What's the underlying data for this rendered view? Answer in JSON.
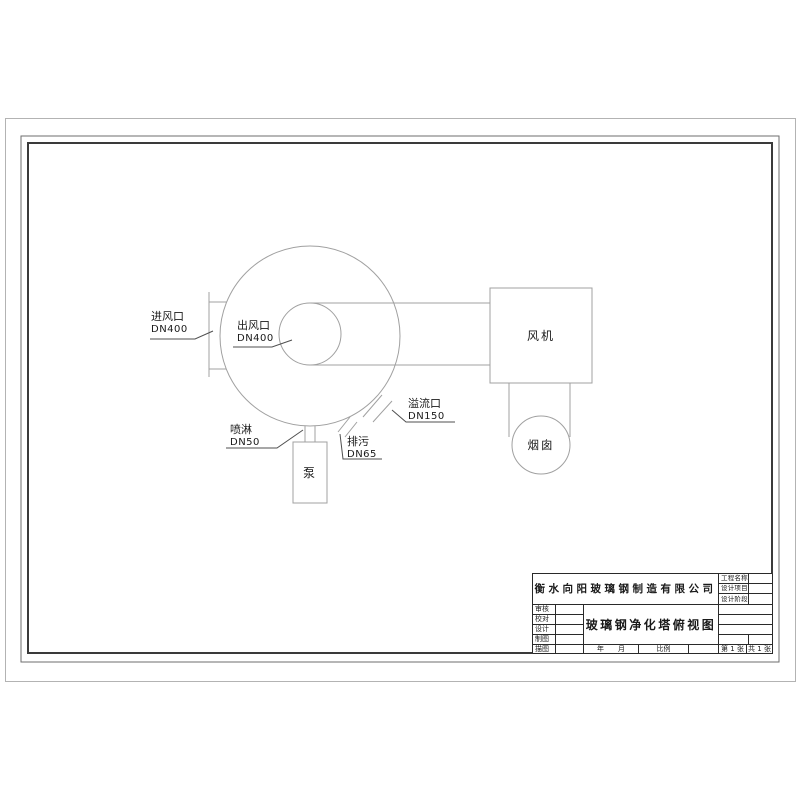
{
  "schematic": {
    "tower_inlet": {
      "name": "进风口",
      "size": "DN400"
    },
    "tower_outlet": {
      "name": "出风口",
      "size": "DN400"
    },
    "spray": {
      "name": "喷淋",
      "size": "DN50"
    },
    "drain": {
      "name": "排污",
      "size": "DN65"
    },
    "overflow": {
      "name": "溢流口",
      "size": "DN150"
    },
    "pump_label": "泵",
    "fan_label": "风机",
    "chimney_label": "烟囱"
  },
  "title_block": {
    "company": "衡水向阳玻璃钢制造有限公司",
    "drawing_title": "玻璃钢净化塔俯视图",
    "review_rows": [
      "审核",
      "校对",
      "设计",
      "制图",
      "描图"
    ],
    "project_rows": [
      "工程名称",
      "设计项目",
      "设计阶段"
    ],
    "year_label": "年",
    "month_label": "月",
    "scale_label": "比例",
    "sheet_no": "第 1 张",
    "sheet_total": "共 1 张"
  },
  "colors": {
    "drawing_line": "#a0a0a0",
    "leader_line": "#4f4f4f",
    "frame_outer": "#6e6e6e",
    "frame_inner": "#3a3a3a",
    "text": "#1a1a1a"
  }
}
